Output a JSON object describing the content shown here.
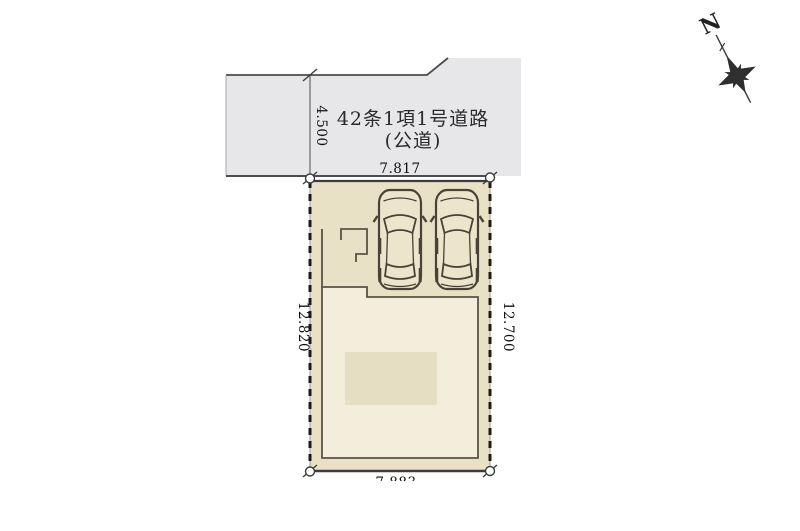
{
  "road": {
    "label_line1": "42条1項1号道路",
    "label_line2": "(公道)",
    "fill": "#e7e7ea"
  },
  "lot": {
    "fill": "#e9e1c6"
  },
  "building": {
    "fill": "#f3eedb",
    "shade_fill": "#e6dec2"
  },
  "dimensions": {
    "road_width": "4.500",
    "lot_top": "7.817",
    "lot_left": "12.820",
    "lot_right": "12.700",
    "lot_bottom": "7.883"
  },
  "compass": {
    "north_label": "N"
  },
  "colors": {
    "edge_dark": "#3d3d3d",
    "dash_black": "#1c1c1c",
    "building_outline": "#5a5244",
    "car_outline": "#4a4236",
    "car_fill": "#ece4cb"
  }
}
